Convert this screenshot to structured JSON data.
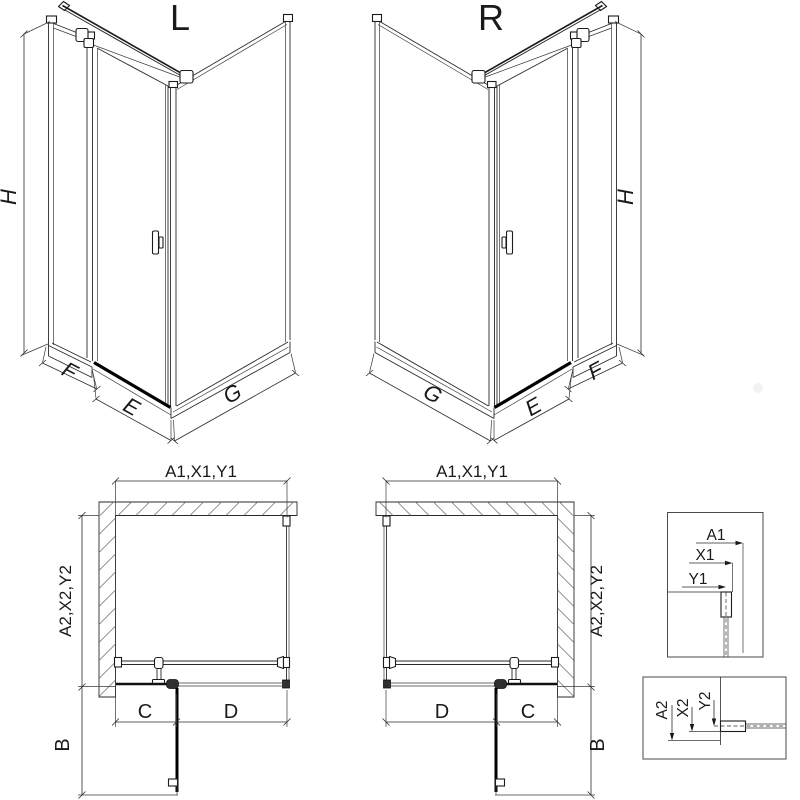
{
  "iso_left": {
    "title": "L",
    "height_label": "H",
    "width_left": "F",
    "width_front": "E",
    "width_side": "G"
  },
  "iso_right": {
    "title": "R",
    "height_label": "H",
    "width_side": "G",
    "width_front": "E",
    "width_right": "F"
  },
  "plan_left": {
    "top_dim": "A1,X1,Y1",
    "side_dim": "A2,X2,Y2",
    "front_left": "C",
    "front_right": "D",
    "door_swing": "B"
  },
  "plan_right": {
    "top_dim": "A1,X1,Y1",
    "side_dim": "A2,X2,Y2",
    "front_left": "D",
    "front_right": "C",
    "door_swing": "B"
  },
  "detail_top": {
    "labels": [
      "A1",
      "X1",
      "Y1"
    ]
  },
  "detail_bottom": {
    "labels": [
      "A2",
      "X2",
      "Y2"
    ]
  },
  "colors": {
    "line": "#2a2a2a",
    "dark": "#000000",
    "hatch": "#606060",
    "background": "#ffffff"
  }
}
